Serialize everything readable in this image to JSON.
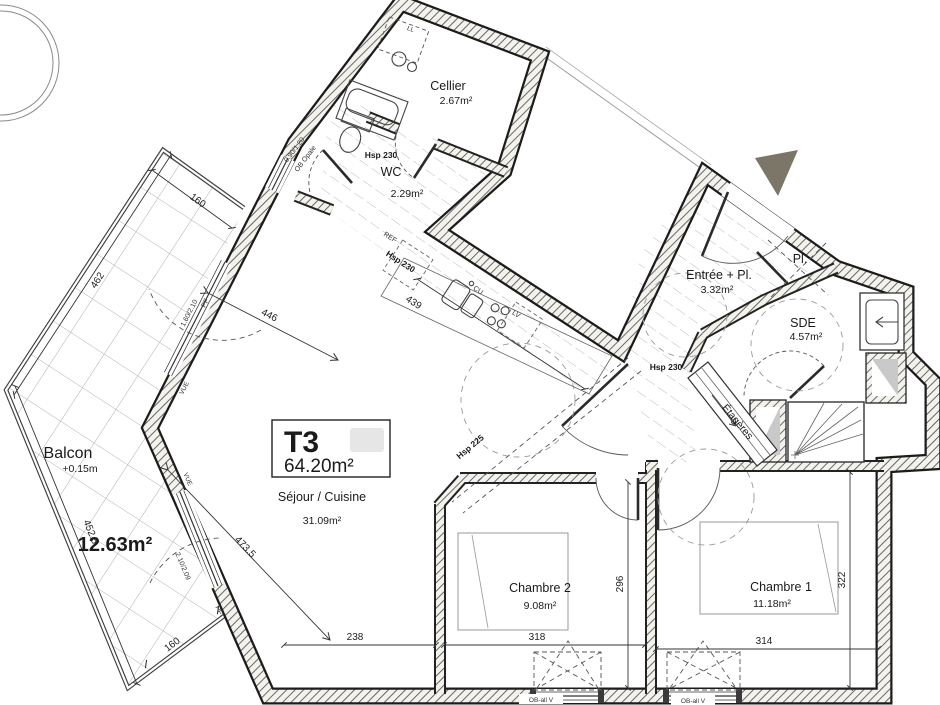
{
  "labels": {
    "t3": "T3",
    "t3_area": "64.20m²",
    "cellier": "Cellier",
    "cellier_area": "2.67m²",
    "wc_hsp": "Hsp 230",
    "wc": "WC",
    "wc_area": "2.29m²",
    "entree": "Entrée + Pl.",
    "entree_area": "3.32m²",
    "entree_hsp": "Hsp 230",
    "pl": "Pl.",
    "ll": "LL",
    "sde": "SDE",
    "sde_area": "4.57m²",
    "etageres": "Étagères",
    "sejour": "Séjour / Cuisine",
    "sejour_area": "31.09m²",
    "kitchen_hsp": "Hsp 230",
    "soffit_hsp": "Hsp 225",
    "ref": "REF",
    "cu": "CU",
    "lv": "LV",
    "ch2": "Chambre 2",
    "ch2_area": "9.08m²",
    "ch1": "Chambre 1",
    "ch1_area": "11.18m²",
    "balcon": "Balcon",
    "balcon_level": "+0.15m",
    "balcon_area": "12.63m²"
  },
  "dims": {
    "top": "160",
    "left_up": "462",
    "left_low": "452.5",
    "bottom": "160",
    "d446": "446",
    "d4735": "473.5",
    "d439": "439",
    "d238": "238",
    "d318": "318",
    "d314": "314",
    "d296": "296",
    "d322": "322"
  },
  "openings": {
    "wc_size": "0.90/1.20",
    "wc_type": "OB Opale",
    "up_size": "1.60/2.10",
    "up_type": "PF",
    "low_size": "2.10/2.09",
    "low_type": "PF",
    "vue": "VUE",
    "ob1": "OB-all V",
    "ob2": "OB-all V"
  },
  "colors": {
    "wall_hatch": "#4e4e4e",
    "entrance_marker": "#7b7668",
    "shaft_grey": "#c9c9c9"
  }
}
